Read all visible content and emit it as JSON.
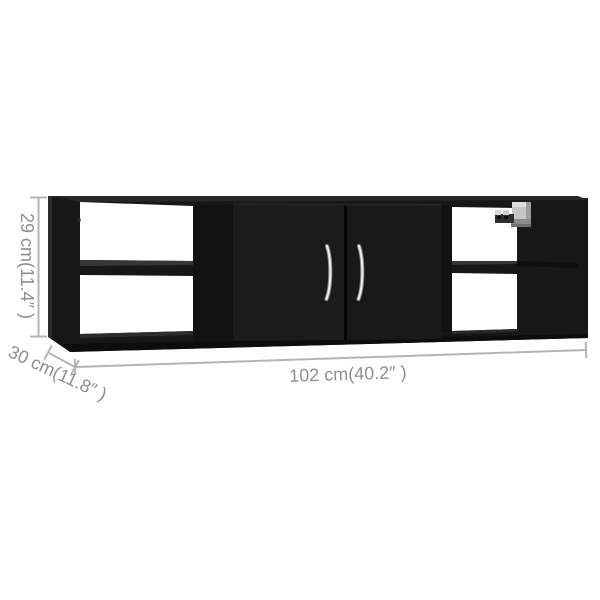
{
  "image": {
    "subject": "black wall-mounted shelf with two doors and open compartments",
    "background_color": "#ffffff"
  },
  "dimensions": {
    "height": {
      "label": "29 cm(11.4″ )",
      "value_cm": 29,
      "value_inch": 11.4
    },
    "depth": {
      "label": "30 cm(11.8″ )",
      "value_cm": 30,
      "value_inch": 11.8
    },
    "width": {
      "label": "102 cm(40.2″ )",
      "value_cm": 102,
      "value_inch": 40.2
    }
  },
  "colors": {
    "shelf_body": "#171717",
    "shelf_top_face": "#272727",
    "door": "#1b1b1b",
    "opening": "#ffffff",
    "dimension_line": "#b4b4b4",
    "dimension_text": "#8e8e8e",
    "handle_chrome": "#ededed",
    "bracket_metal": "#c6c6c6"
  }
}
